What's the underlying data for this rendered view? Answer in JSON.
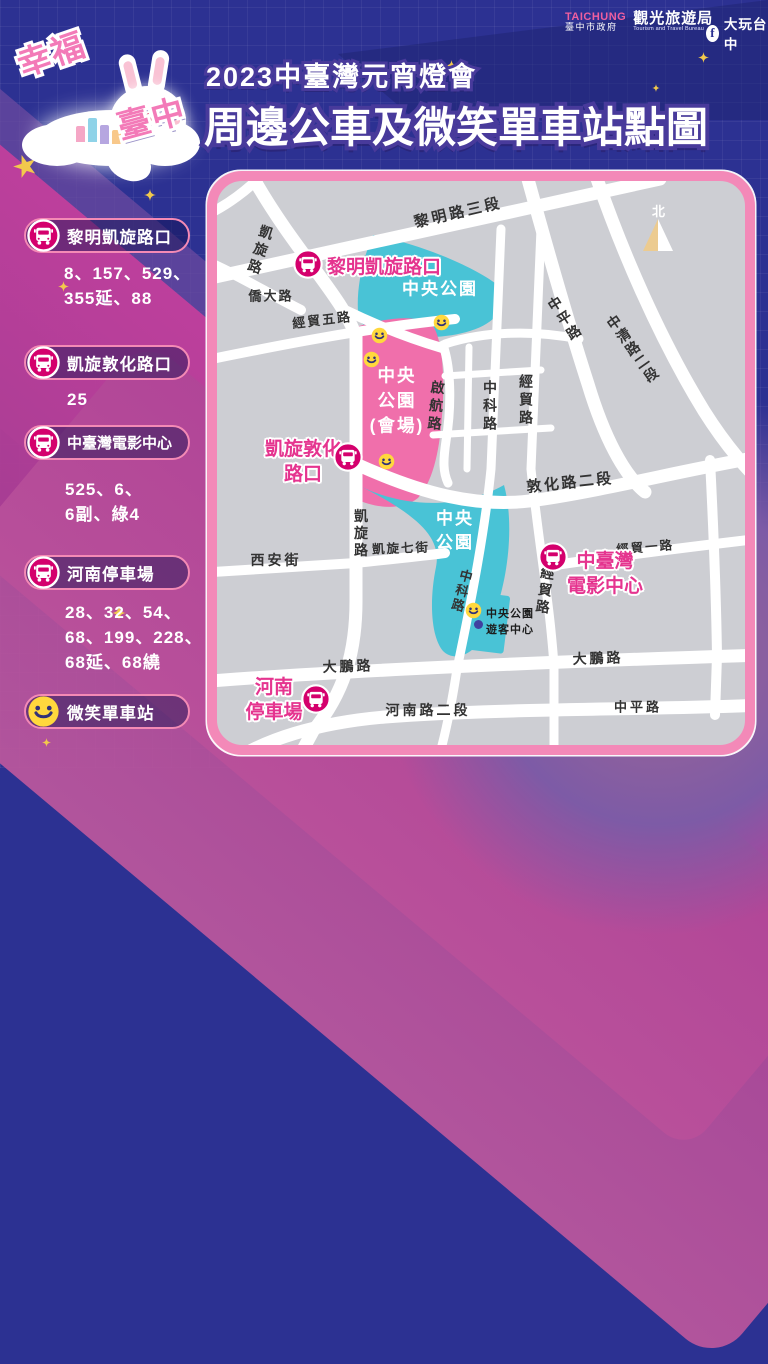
{
  "header": {
    "logo": {
      "taichung_en": "TAICHUNG",
      "taichung_gov": "臺中市政府",
      "bureau": "觀光旅遊局",
      "bureau_en": "Tourism and Travel Bureau"
    },
    "facebook_label": "大玩台中",
    "mascot": {
      "word_top": "幸福",
      "word_bottom": "臺中"
    },
    "subtitle": "2023中臺灣元宵燈會",
    "title": "周邊公車及微笑單車站點圖"
  },
  "legend": {
    "stations": [
      {
        "name": "黎明凱旋路口",
        "routes": [
          "8、157、529、",
          "355延、88"
        ]
      },
      {
        "name": "凱旋敦化路口",
        "routes": [
          "25"
        ]
      },
      {
        "name": "中臺灣電影中心",
        "routes": [
          "525、6、",
          "6副、綠4"
        ]
      },
      {
        "name": "河南停車場",
        "routes": [
          "28、32、54、",
          "68、199、228、",
          "68延、68繞"
        ]
      }
    ],
    "bike_station": {
      "name": "微笑單車站"
    }
  },
  "map": {
    "north": "北",
    "areas": {
      "park_top": {
        "lines": [
          "中央公園"
        ]
      },
      "venue": {
        "lines": [
          "中央",
          "公園",
          "(會場)"
        ]
      },
      "park_lower": {
        "lines": [
          "中央",
          "公園"
        ]
      },
      "visitor_center": {
        "lines": [
          "中央公園",
          "遊客中心"
        ]
      }
    },
    "stops": [
      {
        "name_lines": [
          "黎明凱旋路口"
        ]
      },
      {
        "name_lines": [
          "凱旋敦化",
          "路口"
        ]
      },
      {
        "name_lines": [
          "中臺灣",
          "電影中心"
        ]
      },
      {
        "name_lines": [
          "河南",
          "停車場"
        ]
      }
    ],
    "road_labels": [
      {
        "id": "liming-rd-3",
        "text": "黎明路三段"
      },
      {
        "id": "kaixuan-rd-upper",
        "text": "凱旋路"
      },
      {
        "id": "qiaoda-rd",
        "text": "僑大路"
      },
      {
        "id": "jingmao-5-rd",
        "text": "經貿五路"
      },
      {
        "id": "zhongping-rd-upper",
        "text": "中平路"
      },
      {
        "id": "zhongqing-rd-2",
        "text": "中清路二段"
      },
      {
        "id": "qihang-rd",
        "text": "啟航路"
      },
      {
        "id": "zhongke-rd-upper",
        "text": "中科路"
      },
      {
        "id": "jingmao-rd-upper",
        "text": "經貿路"
      },
      {
        "id": "dunhua-rd-2",
        "text": "敦化路二段"
      },
      {
        "id": "jingmao-1-rd",
        "text": "經貿一路"
      },
      {
        "id": "jingmao-rd-lower",
        "text": "經貿路"
      },
      {
        "id": "kaixuan-rd-lower",
        "text": "凱旋路"
      },
      {
        "id": "kaixuan-7-st",
        "text": "凱旋七街"
      },
      {
        "id": "xian-st",
        "text": "西安街"
      },
      {
        "id": "zhongke-rd-lower",
        "text": "中科路"
      },
      {
        "id": "dapeng-rd-left",
        "text": "大鵬路"
      },
      {
        "id": "dapeng-rd-right",
        "text": "大鵬路"
      },
      {
        "id": "henan-rd-2",
        "text": "河南路二段"
      },
      {
        "id": "zhongping-rd-lower",
        "text": "中平路"
      }
    ]
  },
  "colors": {
    "background_navy": "#2c3192",
    "map_border_pink": "#f389b8",
    "park_cyan": "#49c3d6",
    "venue_pink": "#f06fab",
    "bus_icon_magenta": "#d4006d",
    "stop_text_pink": "#e5348f",
    "smile_yellow": "#ffd83d",
    "band_magenta": "#c23f9c",
    "band_purple": "#6e4b9f"
  }
}
